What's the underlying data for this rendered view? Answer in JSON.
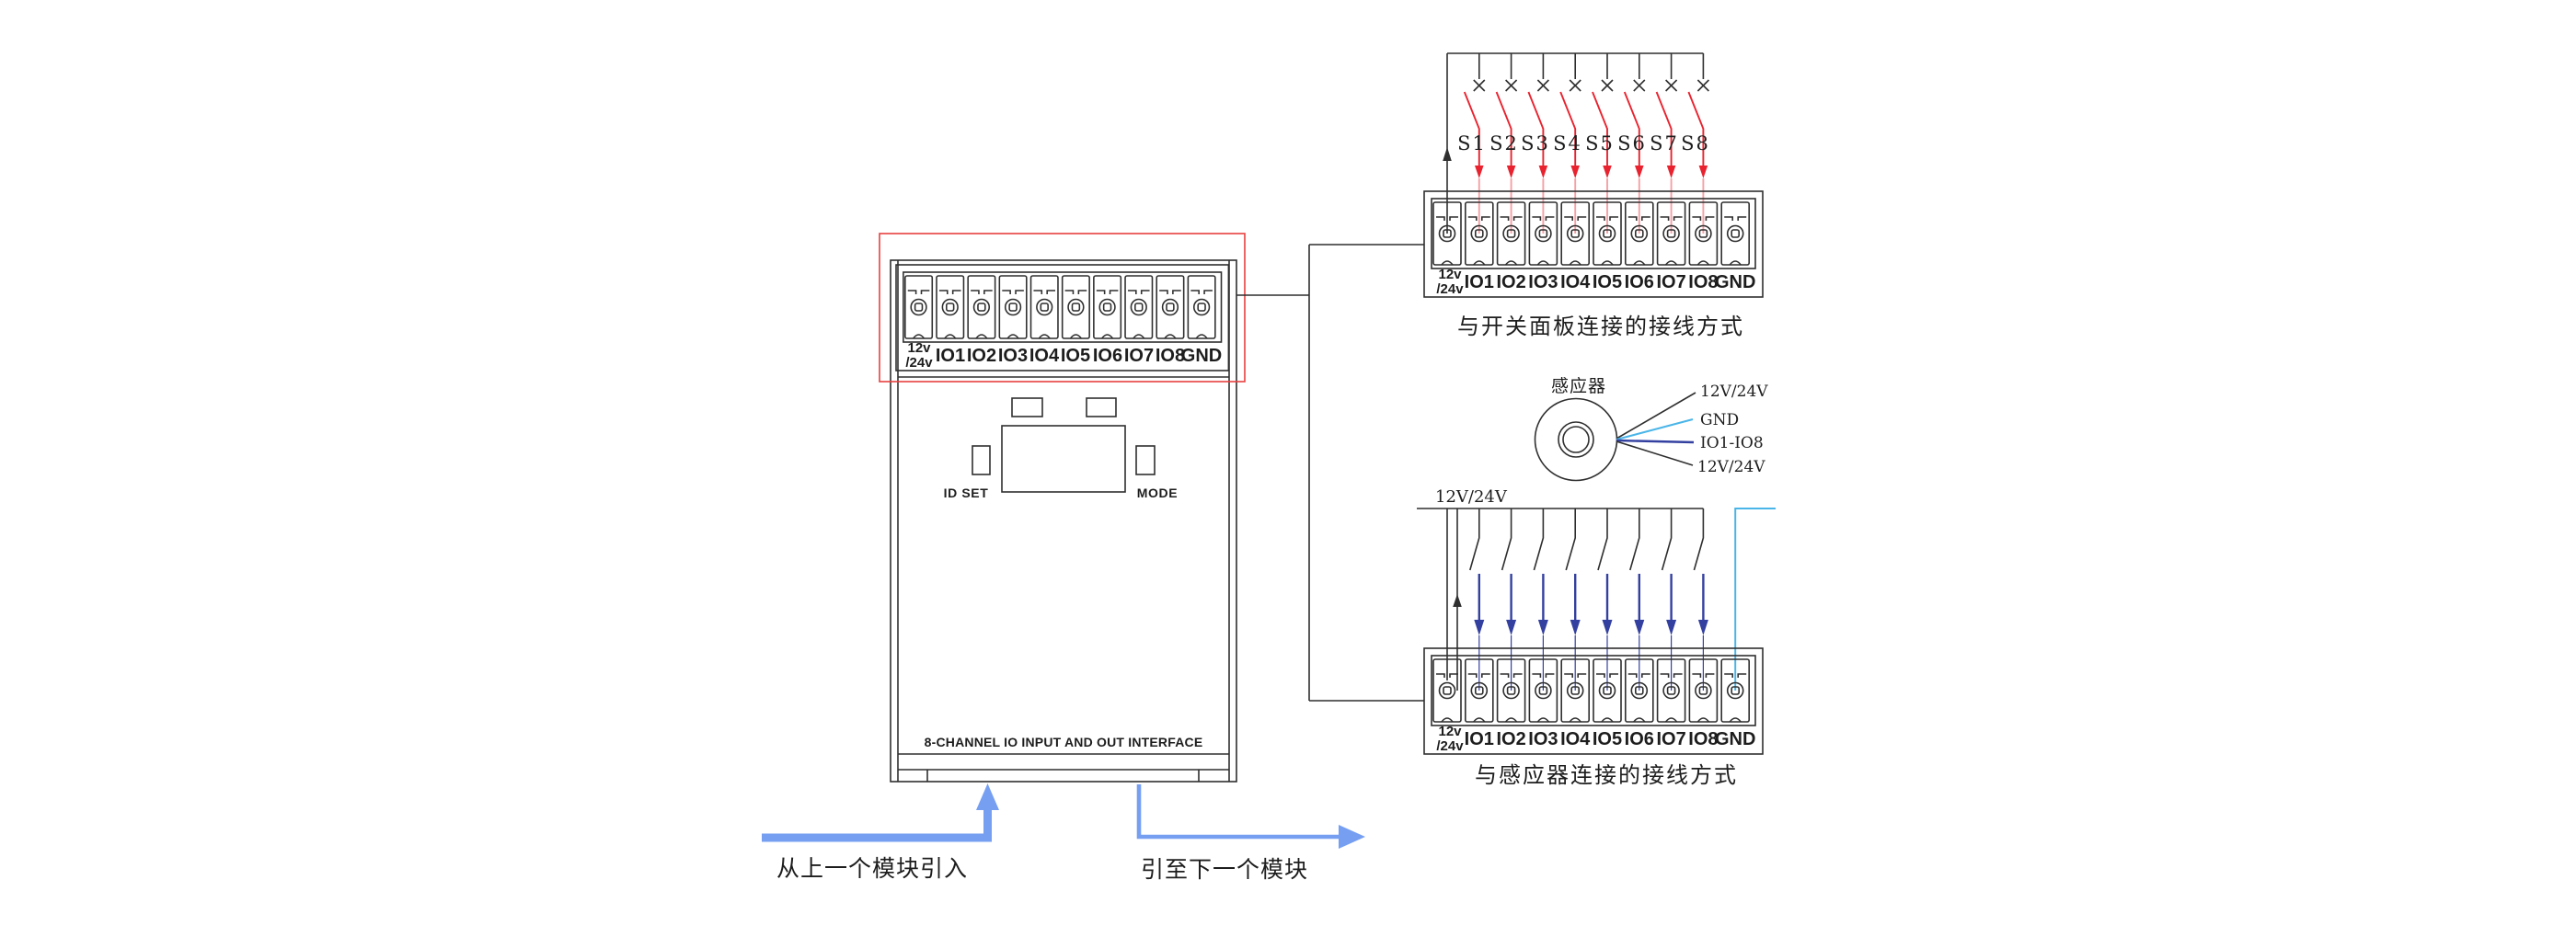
{
  "device": {
    "interface_label": "8-CHANNEL IO INPUT AND OUT INTERFACE",
    "id_set_label": "ID SET",
    "mode_label": "MODE"
  },
  "terminal_block": {
    "power_label_line1": "12v",
    "power_label_line2": "/24v",
    "io_labels": [
      "IO1",
      "IO2",
      "IO3",
      "IO4",
      "IO5",
      "IO6",
      "IO7",
      "IO8"
    ],
    "gnd_label": "GND"
  },
  "switch_panel_diagram": {
    "switch_labels": [
      "S1",
      "S2",
      "S3",
      "S4",
      "S5",
      "S6",
      "S7",
      "S8"
    ],
    "caption": "与开关面板连接的接线方式"
  },
  "sensor_diagram": {
    "sensor_label": "感应器",
    "pin_labels": [
      "12V/24V",
      "GND",
      "IO1-IO8",
      "12V/24V"
    ],
    "bus_label": "12V/24V",
    "caption": "与感应器连接的接线方式"
  },
  "module_links": {
    "from_previous": "从上一个模块引入",
    "to_next": "引至下一个模块"
  },
  "colors": {
    "outline": "#2f2f2f",
    "highlight_red": "#e84040",
    "wire_red": "#e8232f",
    "wire_pink": "#f5a0a5",
    "wire_navy": "#3340a0",
    "wire_cyan": "#4ab5e8",
    "arrow_blue": "#769ff2"
  }
}
